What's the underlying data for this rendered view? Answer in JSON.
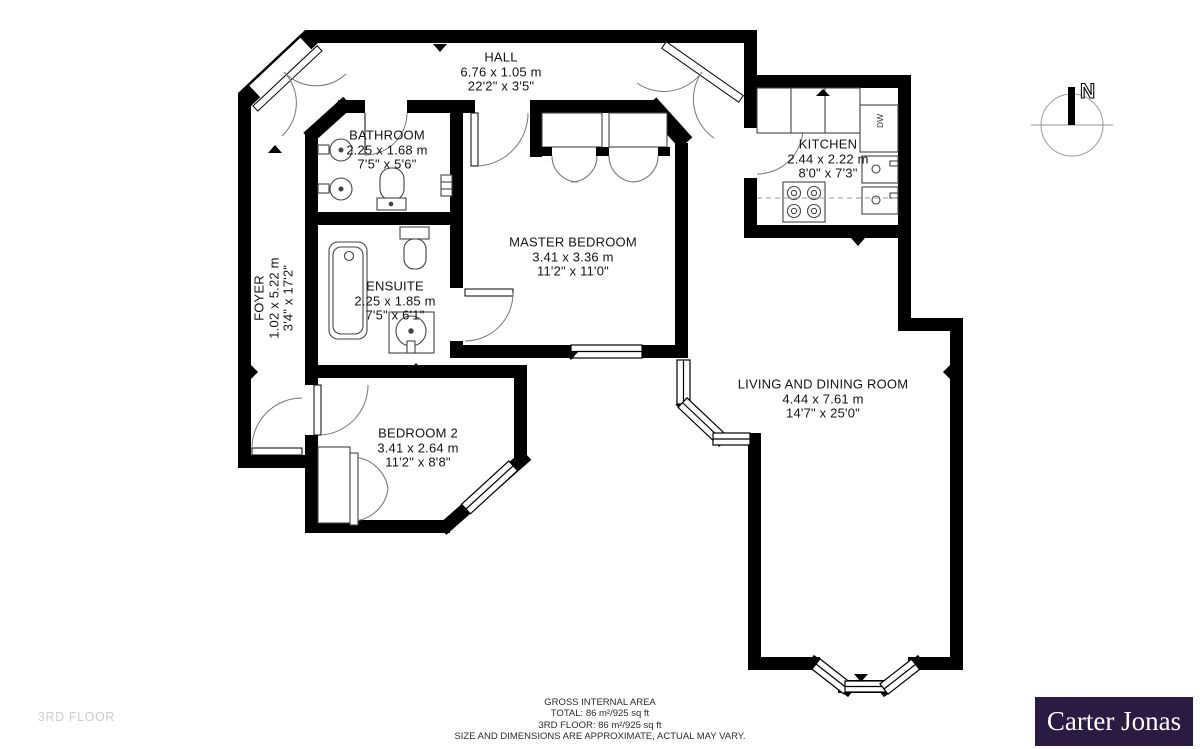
{
  "rooms": [
    {
      "id": "hall",
      "name": "HALL",
      "metric": "6.76 x 1.05 m",
      "imperial": "22'2\" x 3'5\""
    },
    {
      "id": "bathroom",
      "name": "BATHROOM",
      "metric": "2.25 x 1.68 m",
      "imperial": "7'5\" x 5'6\""
    },
    {
      "id": "kitchen",
      "name": "KITCHEN",
      "metric": "2.44 x 2.22 m",
      "imperial": "8'0\" x 7'3\""
    },
    {
      "id": "master_bedroom",
      "name": "MASTER BEDROOM",
      "metric": "3.41 x 3.36 m",
      "imperial": "11'2\" x 11'0\""
    },
    {
      "id": "ensuite",
      "name": "ENSUITE",
      "metric": "2.25 x 1.85 m",
      "imperial": "7'5\" x 6'1\""
    },
    {
      "id": "foyer",
      "name": "FOYER",
      "metric": "1.02 x 5.22 m",
      "imperial": "3'4\" x 17'2\""
    },
    {
      "id": "bedroom2",
      "name": "BEDROOM 2",
      "metric": "3.41 x 2.64 m",
      "imperial": "11'2\" x 8'8\""
    },
    {
      "id": "living_dining",
      "name": "LIVING AND DINING ROOM",
      "metric": "4.44 x 7.61 m",
      "imperial": "14'7\" x 25'0\""
    }
  ],
  "appliance_labels": {
    "dishwasher": "DW"
  },
  "compass": {
    "north_label": "N"
  },
  "footer": {
    "line1": "GROSS INTERNAL AREA",
    "line2": "TOTAL: 86 m²/925 sq ft",
    "line3": "3RD FLOOR: 86 m²/925 sq ft",
    "line4": "SIZE AND DIMENSIONS ARE APPROXIMATE, ACTUAL MAY VARY.",
    "floor_watermark": "3RD FLOOR"
  },
  "branding": {
    "logo_text": "Carter Jonas",
    "logo_bg": "#2b1b42",
    "logo_fg": "#ffffff"
  }
}
